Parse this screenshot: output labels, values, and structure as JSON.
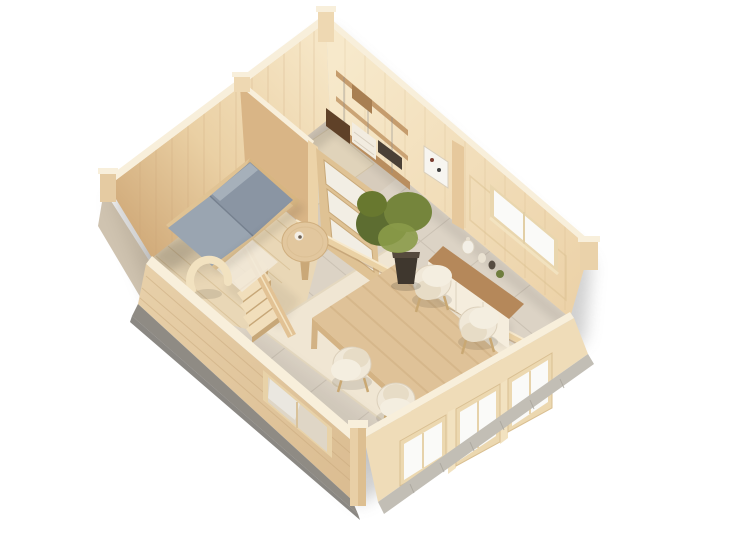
{
  "scene": {
    "subject": "Isometric top-down 3D cutaway render of a wooden log cabin interior",
    "view": "isometric top-down cutaway",
    "background": "#ffffff",
    "rooms": [
      {
        "name": "bedroom",
        "position": "left",
        "furniture": [
          "double-bed",
          "arched-floor-lamp",
          "round-side-table",
          "bedroom-rug",
          "staircase"
        ]
      },
      {
        "name": "study",
        "position": "top",
        "furniture": [
          "wall-shelving-unit",
          "desk-counter",
          "storage-boxes",
          "drawer-cabinet",
          "area-rug"
        ]
      },
      {
        "name": "living-dining-room",
        "position": "center-right",
        "furniture": [
          "dining-table",
          "dining-chairs",
          "area-rug",
          "potted-plant",
          "sideboard-with-vases",
          "wall-art-frame"
        ]
      }
    ],
    "architecture": [
      "log-walls",
      "interior-partition-wall",
      "glazed-interior-door",
      "hallway-rail",
      "corner-posts",
      "rear-wall-window",
      "front-wall-windows",
      "gray-foundation-base"
    ],
    "counts": {
      "dining-chairs": 4,
      "stair-steps": 5,
      "front-right-windows": 3
    },
    "palette": {
      "background": "#ffffff",
      "wood-light": "#f5e4c2",
      "wood-mid": "#e9cfa4",
      "wood-shadow": "#d9b98c",
      "wood-deep": "#c49a6c",
      "wood-top": "#f8efdb",
      "floor-tile": "#dcd3c5",
      "floor-grout": "#c6bcae",
      "floor-wood": "#e9d7b6",
      "plank-line": "#d8c096",
      "rug-main": "#f0e6d3",
      "rug-office": "#e0d3ba",
      "bed-dark": "#8a95a3",
      "bed-light": "#9aa5b1",
      "bed-frame": "#e0c394",
      "chair-body": "#f0e8d8",
      "chair-seat": "#e7dcc6",
      "chair-leg": "#c9a873",
      "table-top": "#dfc298",
      "table-grain": "#cdac7c",
      "table-edge": "#c6a376",
      "sideboard-top": "#b5885a",
      "sideboard-body": "#f5eddd",
      "plant-dark": "#5d6d31",
      "plant-mid": "#75853c",
      "plant-light": "#8b9b49",
      "pot": "#3f372e",
      "glass": "#fafaf8",
      "door-wood": "#dfc294",
      "stair-tread": "#f1debb",
      "stair-riser": "#c7a778",
      "foundation-dark": "#8f8b84",
      "foundation-light": "#c2beb5",
      "art-white": "#f7f5f0",
      "shadow": "#8a8a8a"
    }
  }
}
